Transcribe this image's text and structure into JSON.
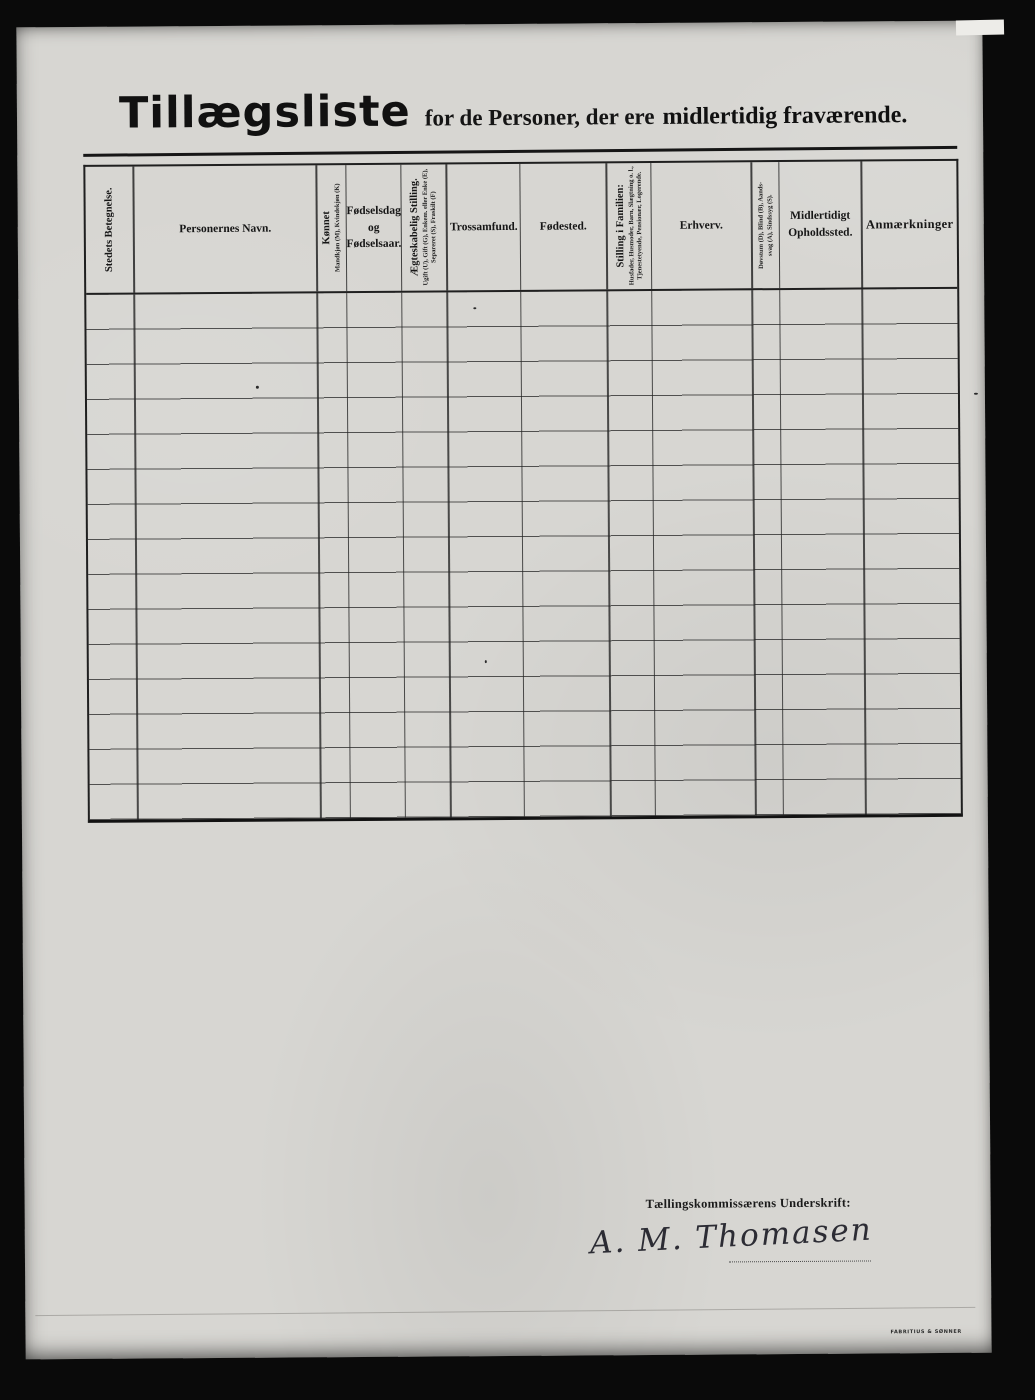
{
  "document": {
    "title": {
      "main": "Tillægsliste",
      "subtitle_regular": "for de Personer, der ere",
      "subtitle_bold": "midlertidig fraværende."
    }
  },
  "table": {
    "columns": [
      {
        "label": "Stedets Betegnelse.",
        "orientation": "vertical"
      },
      {
        "label": "Personernes Navn.",
        "orientation": "horizontal"
      },
      {
        "label": "Kønnet",
        "sub": "Mandkjøn (M), Kvindekjøn (K)",
        "orientation": "vertical"
      },
      {
        "label": "Fødselsdag og Fødselsaar.",
        "orientation": "horizontal"
      },
      {
        "label": "Ægteskabelig Stilling.",
        "sub": "Ugift (U), Gift (G), Enkem. eller Enke (E), Separeret (S), Fraskilt (F)",
        "orientation": "vertical"
      },
      {
        "label": "Trossamfund.",
        "orientation": "horizontal"
      },
      {
        "label": "Fødested.",
        "orientation": "horizontal"
      },
      {
        "label": "Stilling i Familien:",
        "sub": "Husfader, Husmoder, Barn, Slægtning o. l., Tjenestetyende, Pensionær, Logerende.",
        "orientation": "vertical"
      },
      {
        "label": "Erhverv.",
        "orientation": "horizontal"
      },
      {
        "label": "Døvstum (D), Blind (B), Aands-",
        "sub": "svag (A), Sindssyg (S).",
        "orientation": "vertical"
      },
      {
        "label": "Midlertidigt Opholdssted.",
        "orientation": "horizontal"
      },
      {
        "label": "Anmærkninger",
        "orientation": "horizontal"
      }
    ],
    "row_count": 15,
    "rows": []
  },
  "footer": {
    "signature_label": "Tællingskommissærens Underskrift:",
    "signature": "A. M. Thomasen",
    "printer_mark": "FABRITIUS & SØNNER"
  },
  "colors": {
    "paper": "#d7d6d2",
    "ink": "#1c1c1c",
    "scan_background": "#0a0a0a"
  }
}
